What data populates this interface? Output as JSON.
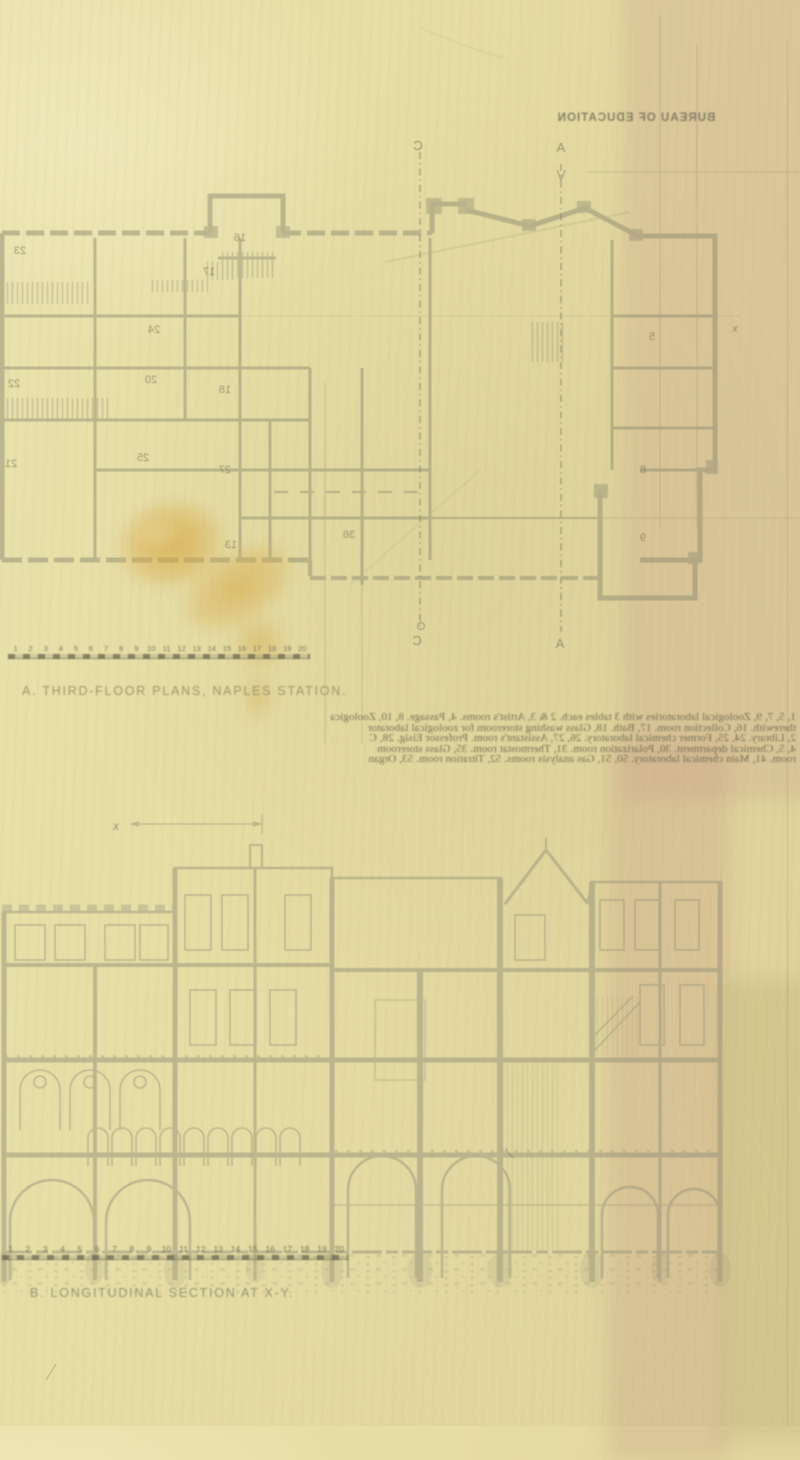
{
  "document": {
    "showthrough_header": "BUREAU OF EDUCATION",
    "captions": {
      "plan": "A. THIRD-FLOOR PLANS, NAPLES STATION.",
      "section": "B. LONGITUDINAL SECTION AT X-Y."
    },
    "scale_bars": {
      "ticks": [
        "1",
        "2",
        "3",
        "4",
        "5",
        "6",
        "7",
        "8",
        "9",
        "10",
        "11",
        "12",
        "13",
        "14",
        "15",
        "16",
        "17",
        "18",
        "19",
        "20"
      ]
    },
    "plan": {
      "section_line_markers": {
        "top_left": "C",
        "top_right": "A",
        "bottom_left": "C",
        "bottom_right": "A",
        "x_mark": "x"
      },
      "room_numbers": [
        {
          "n": "23",
          "x": 20,
          "y": 254
        },
        {
          "n": "16",
          "x": 240,
          "y": 241
        },
        {
          "n": "17",
          "x": 209,
          "y": 275
        },
        {
          "n": "24",
          "x": 154,
          "y": 333
        },
        {
          "n": "20",
          "x": 151,
          "y": 383
        },
        {
          "n": "22",
          "x": 14,
          "y": 387
        },
        {
          "n": "18",
          "x": 225,
          "y": 393
        },
        {
          "n": "25",
          "x": 143,
          "y": 461
        },
        {
          "n": "21",
          "x": 11,
          "y": 467
        },
        {
          "n": "27",
          "x": 225,
          "y": 473
        },
        {
          "n": "13",
          "x": 231,
          "y": 548
        },
        {
          "n": "36",
          "x": 349,
          "y": 538
        },
        {
          "n": "5",
          "x": 652,
          "y": 340
        },
        {
          "n": "8",
          "x": 643,
          "y": 473
        },
        {
          "n": "9",
          "x": 643,
          "y": 541
        }
      ]
    },
    "section": {
      "dimension_label": "x"
    },
    "showthrough_paragraph": [
      "1, 5, 7, 9, Zoological laboratories with 3 tables each.  2 & 3, Artist's rooms.  4, Passage.  8, 10, Zoologica",
      "therewith.  16, Collection room.  17, Bath.  18, Glass washing storeroom for zoological laborator",
      "2, Library.  24, 25, Former chemical laboratory.  26, 27, Assistant's room.  Professor Eisig.  28, C",
      "4, 5, Chemical department.  30, Polarization room.  31, Thermostat room.  35, Glass storeroom",
      "room.  41, Main chemical laboratory.  50, 51, Gas analysis rooms.  52, Titration room.  53, Organ"
    ]
  },
  "colors": {
    "paper": "#e6dda4",
    "paper_light": "#ece4b2",
    "pink_band": "#d8c2a6",
    "ink": "#8d8a70",
    "caption_ink": "#968e68",
    "stain": "#d49e32"
  }
}
